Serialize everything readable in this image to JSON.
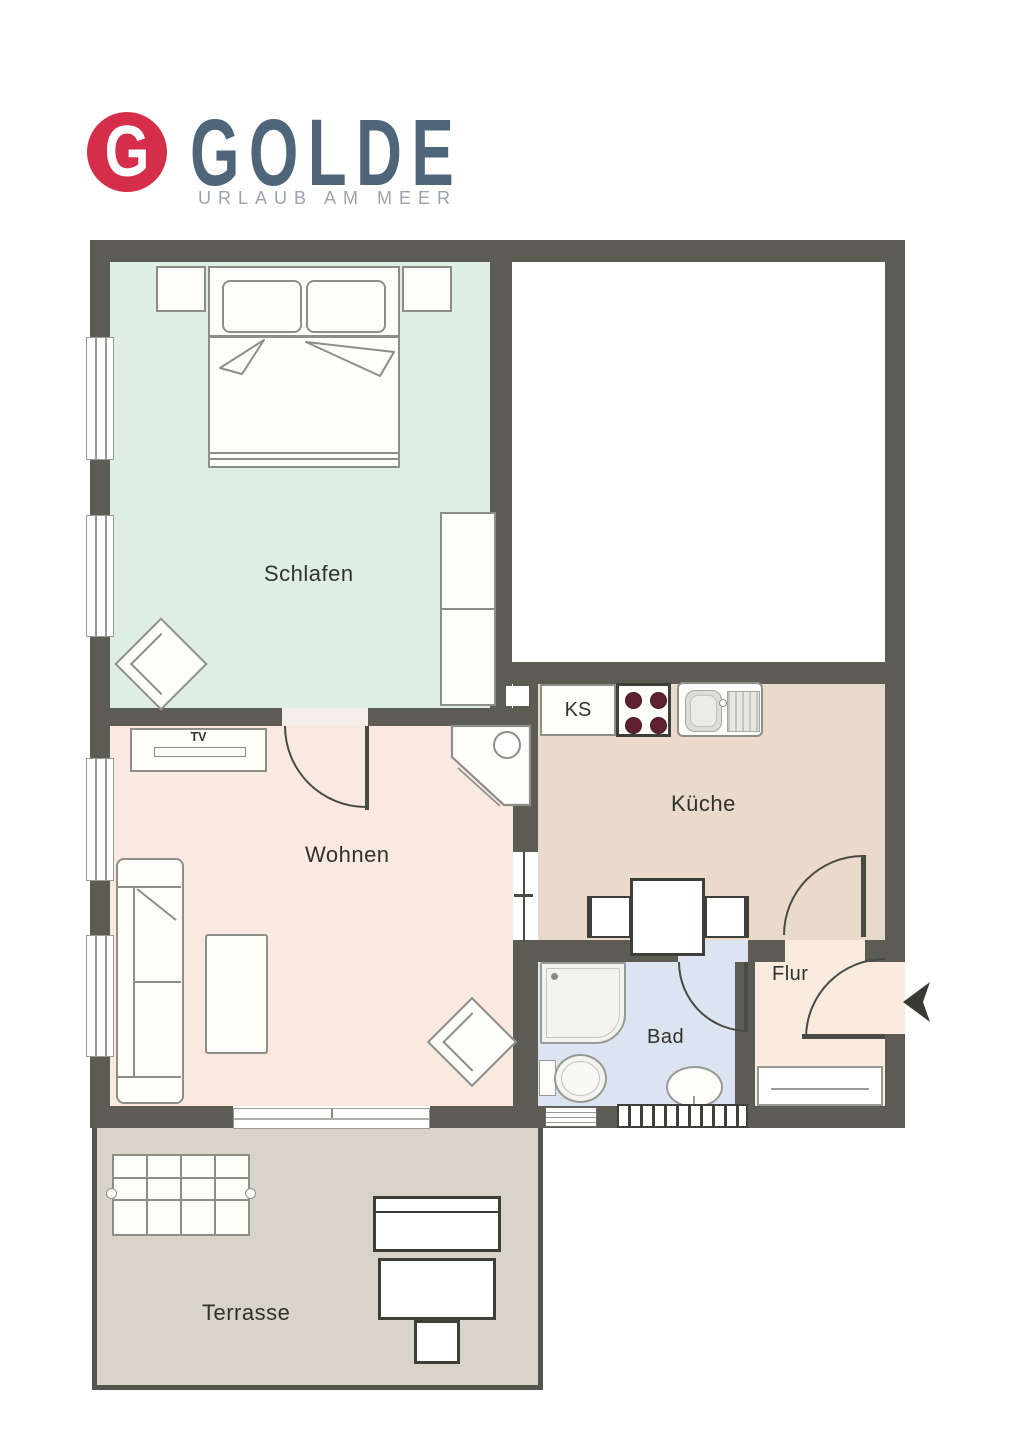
{
  "logo": {
    "letter": "G",
    "brand": "GOLDE",
    "tagline": "URLAUB AM MEER",
    "circle_color": "#d42e4a",
    "brand_color": "#4f6579",
    "tagline_color": "#9aa3ac"
  },
  "rooms": {
    "schlafen": {
      "label": "Schlafen",
      "color": "#dfeee2"
    },
    "wohnen": {
      "label": "Wohnen",
      "color": "#f9e9e1"
    },
    "kueche": {
      "label": "Küche",
      "color": "#e9dacb"
    },
    "bad": {
      "label": "Bad",
      "color": "#dce4f1"
    },
    "flur": {
      "label": "Flur",
      "color": "#f9ecdf"
    },
    "terrasse": {
      "label": "Terrasse",
      "color": "#d8d4c9"
    },
    "empty": {
      "label": "",
      "color": "#ffffff"
    }
  },
  "furniture": {
    "fridge_label": "KS",
    "tv_label": "TV"
  },
  "colors": {
    "wall": "#5c5c55",
    "door": "#4a4a44",
    "furniture_outline": "#8e8e88",
    "dark_outline": "#3f3f3a",
    "window_frame": "#9a9a94",
    "burner": "#5d2130",
    "arrow": "#3a3a35",
    "label": "#32322d",
    "terrace_border": "#55554f",
    "page_bg": "#ffffff"
  }
}
